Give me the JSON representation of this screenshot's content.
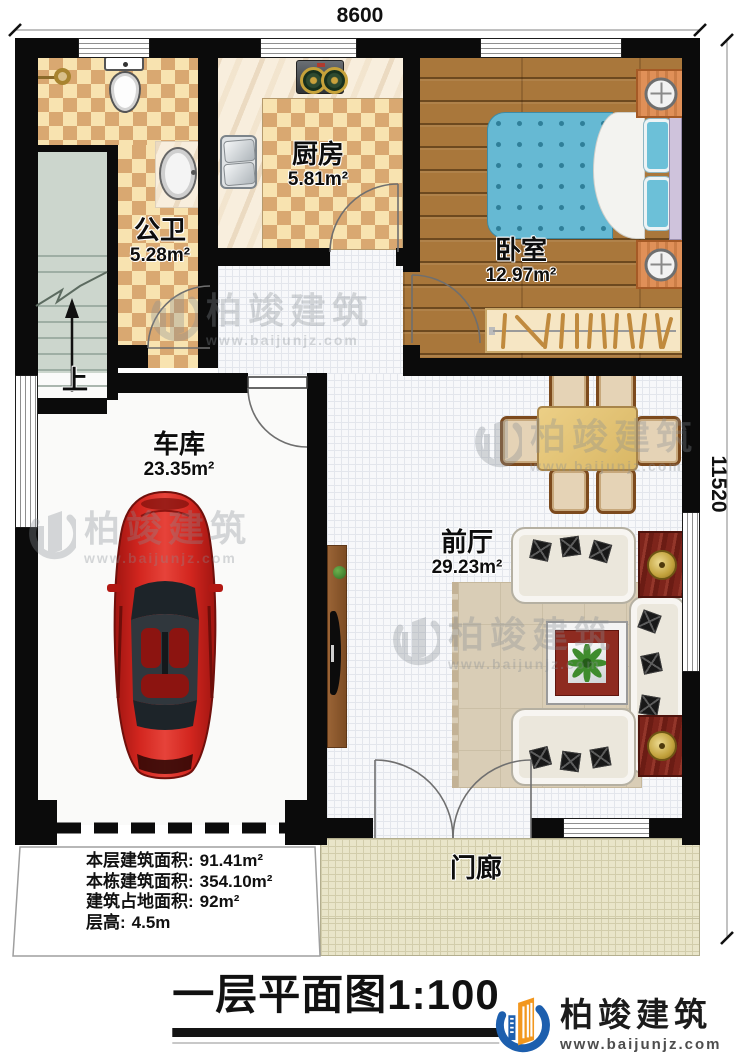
{
  "dimensions": {
    "top": "8600",
    "right": "11520"
  },
  "rooms": {
    "bathroom": {
      "name": "公卫",
      "area": "5.28m²"
    },
    "kitchen": {
      "name": "厨房",
      "area": "5.81m²"
    },
    "bedroom": {
      "name": "卧室",
      "area": "12.97m²"
    },
    "garage": {
      "name": "车库",
      "area": "23.35m²"
    },
    "hall": {
      "name": "前厅",
      "area": "29.23m²"
    },
    "porch": {
      "name": "门廊"
    }
  },
  "stair": {
    "up_label": "上"
  },
  "stats": {
    "rows": [
      {
        "label": "本层建筑面积:",
        "value": "91.41m²"
      },
      {
        "label": "本栋建筑面积:",
        "value": "354.10m²"
      },
      {
        "label": "建筑占地面积:",
        "value": "92m²"
      },
      {
        "label": "层高:",
        "value": "4.5m"
      }
    ]
  },
  "title": {
    "text": "一层平面图",
    "scale": "1:100"
  },
  "logo": {
    "name": "柏竣建筑",
    "url": "www.baijunjz.com"
  },
  "watermark": {
    "name": "柏竣建筑",
    "url": "www.baijunjz.com"
  },
  "icons": {
    "stair_up_arrow": "↑"
  },
  "colors": {
    "wall": "#0b0b0b",
    "tile_light": "#f8e3b0",
    "tile_dark": "#d9a871",
    "wood": "#a9773b",
    "mattress": "#66b9d3",
    "car": "#c8201b",
    "logo_blue": "#1d5fae",
    "logo_orange": "#f2971e",
    "porch": "#e9e5c9"
  }
}
